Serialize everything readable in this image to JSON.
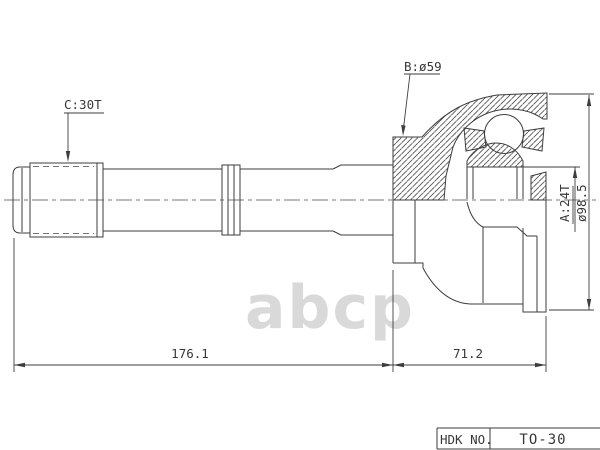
{
  "drawing": {
    "watermark": "abcp",
    "labels": {
      "spline_left": "C:30T",
      "boot_diameter": "B:ø59",
      "spline_outer": "A:24T",
      "outer_diameter": "ø98.5"
    },
    "dimensions": {
      "shaft_length": "176.1",
      "outer_joint_length": "71.2"
    },
    "title_block": {
      "field_label": "HDK NO.",
      "value": "TO-30"
    }
  }
}
